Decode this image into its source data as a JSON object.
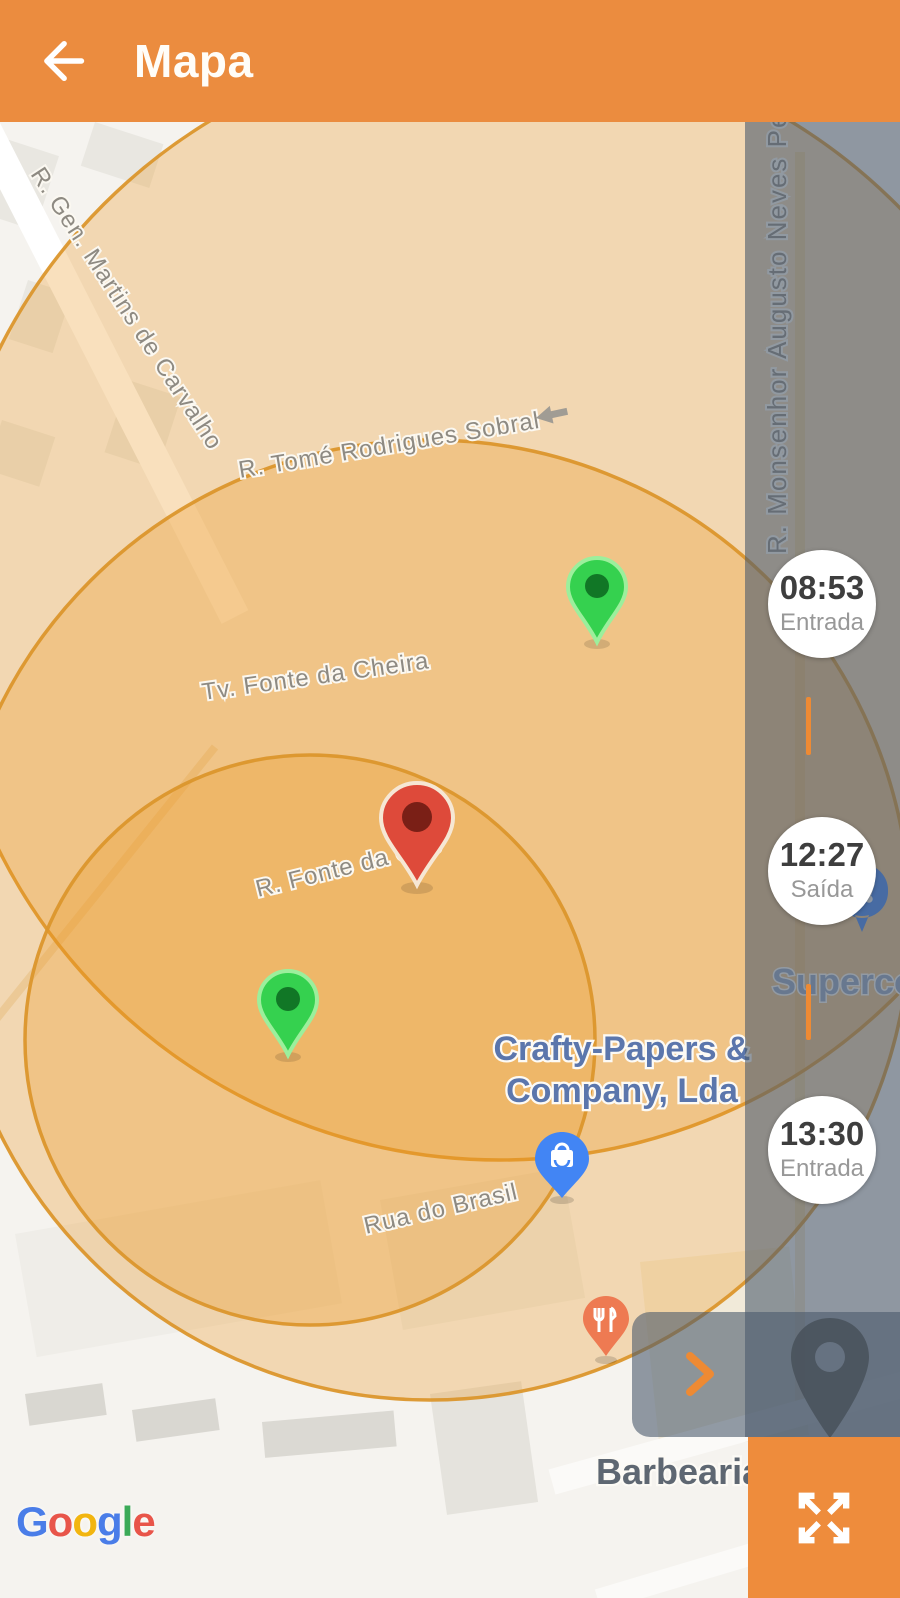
{
  "header": {
    "title": "Mapa",
    "back_icon": "arrow-left",
    "color": "#EB8C3F"
  },
  "map": {
    "provider_attribution": "Google",
    "street_labels": [
      "R. Gen. Martins de Carvalho",
      "R. Tomé Rodrigues Sobral",
      "Tv. Fonte da Cheira",
      "R. Fonte da Che",
      "Rua do Brasil",
      "R. Monsenhor Augusto Neves Pereira"
    ],
    "poi": {
      "supermarket_label": "Superco",
      "shop_label_line1": "Crafty-Papers &",
      "shop_label_line2": "Company, Lda",
      "barber_label": "Barbearia S",
      "shop_marker_icon": "shopping-bag",
      "supermarket_marker_icon": "shopping-cart",
      "restaurant_marker_icon": "fork-knife"
    },
    "markers": {
      "green_pin_color": "#35D14F",
      "red_pin_color": "#DE4A3A",
      "blue_poi_color": "#4285F4",
      "restaurant_poi_color": "#EE7A52",
      "dark_pin_color": "#49525B"
    },
    "geofence": {
      "fill": "rgba(236,152,36,0.30)",
      "stroke": "#DB962C"
    }
  },
  "timeline": {
    "events": [
      {
        "time": "08:53",
        "label": "Entrada"
      },
      {
        "time": "12:27",
        "label": "Saída"
      },
      {
        "time": "13:30",
        "label": "Entrada"
      }
    ],
    "connector_color": "#EE8A33"
  },
  "controls": {
    "expand_icon": "fullscreen-expand-arrows",
    "next_icon": "chevron-right",
    "one_way_icon": "arrow-left-small"
  },
  "attribution": {
    "text": "Google",
    "letters": [
      {
        "char": "G",
        "color": "#4A7DE8"
      },
      {
        "char": "o",
        "color": "#E8554A"
      },
      {
        "char": "o",
        "color": "#F2B50F"
      },
      {
        "char": "g",
        "color": "#4A7DE8"
      },
      {
        "char": "l",
        "color": "#3BAA58"
      },
      {
        "char": "e",
        "color": "#E8554A"
      }
    ]
  }
}
